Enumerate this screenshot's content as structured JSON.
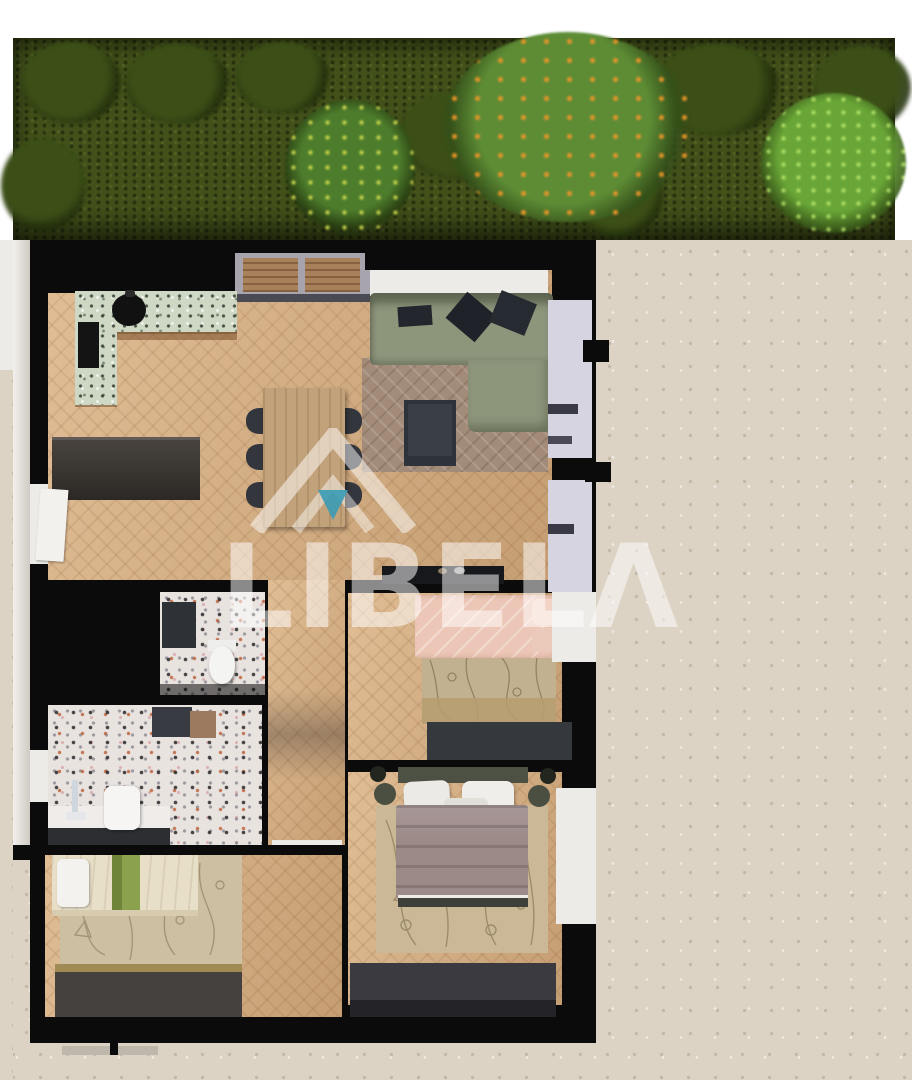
{
  "watermark": {
    "brand": "LIBELΛ",
    "brand_plain": "LIBELA",
    "logo": "roof-house-icon",
    "accent_color": "#3a9cb5",
    "text_color": "rgba(255,255,255,0.52)"
  },
  "scene": {
    "type": "3d-floor-plan-top-view",
    "areas": [
      "garden",
      "terrace",
      "kitchen",
      "dining-area",
      "living-room",
      "entry",
      "hallway",
      "wc",
      "bathroom",
      "bedroom-child",
      "bedroom-guest",
      "bedroom-master",
      "surrounding-concrete"
    ]
  },
  "palette": {
    "grass": "#42501a",
    "treegreen": "#3c4f17",
    "concrete": "#dcd3c4",
    "black": "#0b0b0b",
    "wallwhite": "#edebe8",
    "lavender": "#d7d4e1",
    "wood": "#d6ab7c",
    "terrazzo": "#e9e3e0",
    "counter": "#ced8c4",
    "sofa": "#8d957b",
    "ruglive": "#a28b79",
    "rugbeige": "#cdbfa2",
    "pillowdark": "#23262c",
    "tabledark": "#3a3f47",
    "tablewood": "#c2a27a",
    "pink": "#ecc6b6",
    "mauve": "#9c8a88",
    "headboard": "#4c5143",
    "cream": "#e8dfc8",
    "stripe": "#8ba14e",
    "darkfurn": "#35393d",
    "console": "#38332e",
    "teal": "#3a9cb5",
    "wmtext": "rgba(255,255,255,0.52)"
  }
}
